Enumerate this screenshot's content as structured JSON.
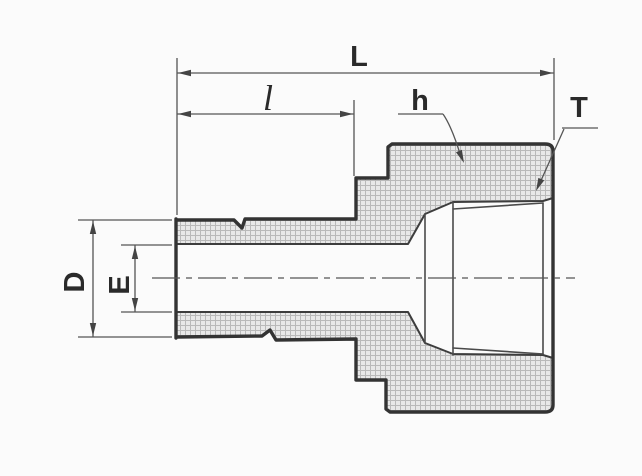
{
  "diagram": {
    "labels": {
      "overall_length": "L",
      "stem_length": "l",
      "body": "h",
      "thread": "T",
      "outer_diameter": "D",
      "bore_diameter": "E"
    },
    "colors": {
      "outline": "#333333",
      "thin_line": "#555555",
      "label_text": "#2a2a2a",
      "hatch_line": "#b9b9b9",
      "hatch_fill": "#e8e8e8",
      "background": "#fbfbfb"
    }
  }
}
